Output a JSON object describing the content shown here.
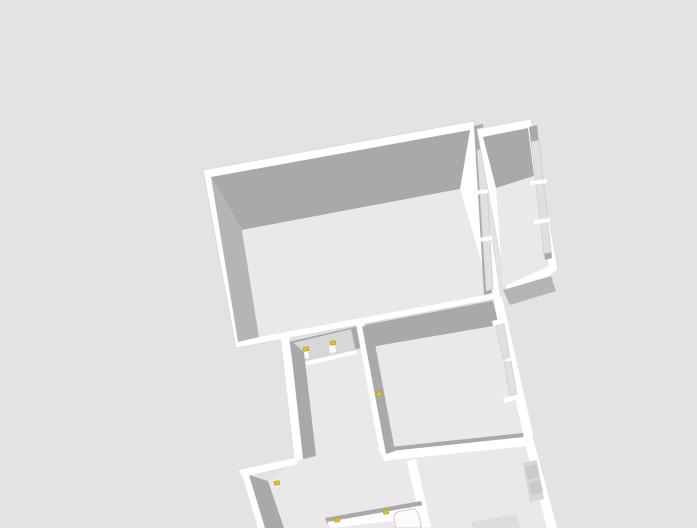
{
  "scene": {
    "type": "3d-floorplan-dollhouse-view",
    "canvas": {
      "width": 697,
      "height": 528
    },
    "colors": {
      "bg": "#e3e3e3",
      "wall": "#ffffff",
      "face": "#a9a9a9",
      "faceLight": "#b5b5b5",
      "floor": "#e9e9e9",
      "pane": "#e0e0e0",
      "paneEdge": "#c6c6c6",
      "panel": "#d7d7d7",
      "panelDark": "#c9c9c9",
      "outline": "#d8d8d8",
      "shadow": "#d4d4d4",
      "marker": "#e6c229",
      "markerEdge": "#a68d14"
    },
    "markers": [
      {
        "x": 306,
        "y": 349
      },
      {
        "x": 333,
        "y": 343
      },
      {
        "x": 379,
        "y": 394
      },
      {
        "x": 277,
        "y": 483
      },
      {
        "x": 337,
        "y": 520
      },
      {
        "x": 386,
        "y": 512
      }
    ],
    "marker_size": {
      "w": 5.5,
      "h": 4,
      "rotation": -11
    }
  }
}
